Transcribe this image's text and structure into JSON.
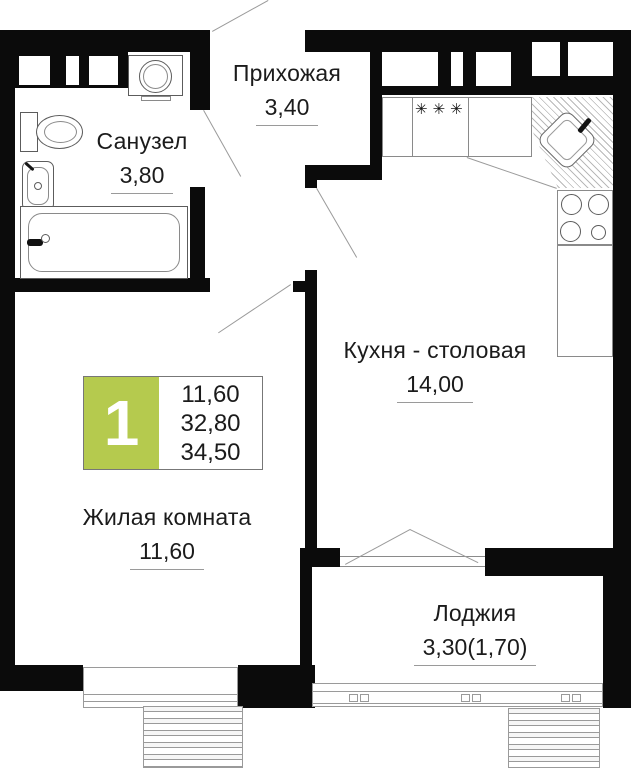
{
  "colors": {
    "wall": "#0b0b0b",
    "accent_green": "#b5ca4e",
    "text": "#1b1b1b",
    "line": "#9a9a9a"
  },
  "rooms": [
    {
      "id": "hallway",
      "name": "Прихожая",
      "area": "3,40"
    },
    {
      "id": "bathroom",
      "name": "Санузел",
      "area": "3,80"
    },
    {
      "id": "kitchen",
      "name": "Кухня - столовая",
      "area": "14,00"
    },
    {
      "id": "living",
      "name": "Жилая комната",
      "area": "11,60"
    },
    {
      "id": "loggia",
      "name": "Лоджия",
      "area": "3,30(1,70)"
    }
  ],
  "badge": {
    "rooms_count": "1",
    "values": [
      "11,60",
      "32,80",
      "34,50"
    ]
  },
  "kitchen_symbols": {
    "hob": "✳✳✳"
  }
}
